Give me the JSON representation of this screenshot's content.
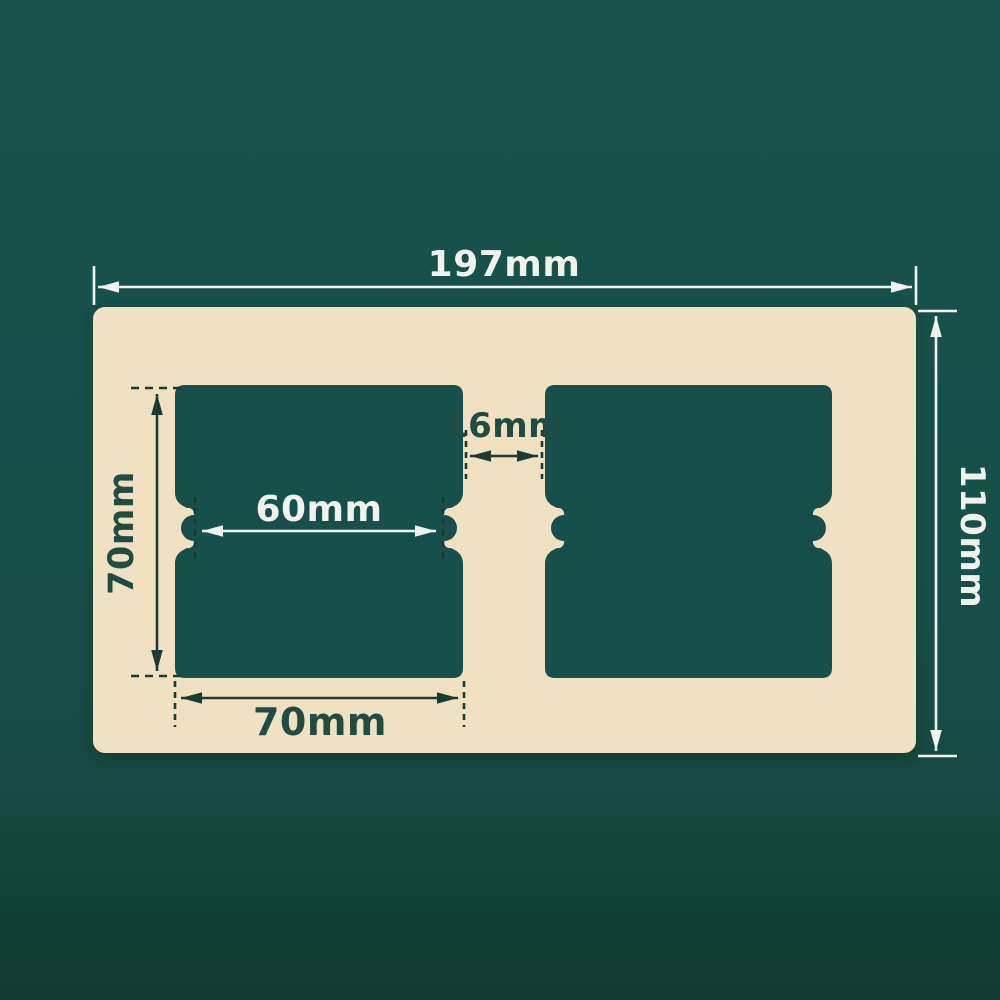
{
  "colors": {
    "background_top": "#18524B",
    "background_bottom": "#113A32",
    "plate": "#F0E1C3",
    "cutout": "#17504A",
    "dim_light": "#EFF3EC",
    "dim_dark_line": "#1C3A32",
    "dim_dark_text": "#214C41"
  },
  "diagram": {
    "subject": "double-gang wall plate frame with two square openings",
    "unit": "mm",
    "labels": {
      "overall_width": "197mm",
      "overall_height": "110mm",
      "cutout_height": "70mm",
      "cutout_width": "70mm",
      "notch_span": "60mm",
      "center_gap": "16mm"
    },
    "measurements": [
      {
        "name": "overall_width",
        "value": 197,
        "unit": "mm"
      },
      {
        "name": "overall_height",
        "value": 110,
        "unit": "mm"
      },
      {
        "name": "cutout_height",
        "value": 70,
        "unit": "mm"
      },
      {
        "name": "cutout_width",
        "value": 70,
        "unit": "mm"
      },
      {
        "name": "notch_span",
        "value": 60,
        "unit": "mm"
      },
      {
        "name": "center_gap",
        "value": 16,
        "unit": "mm"
      }
    ]
  }
}
